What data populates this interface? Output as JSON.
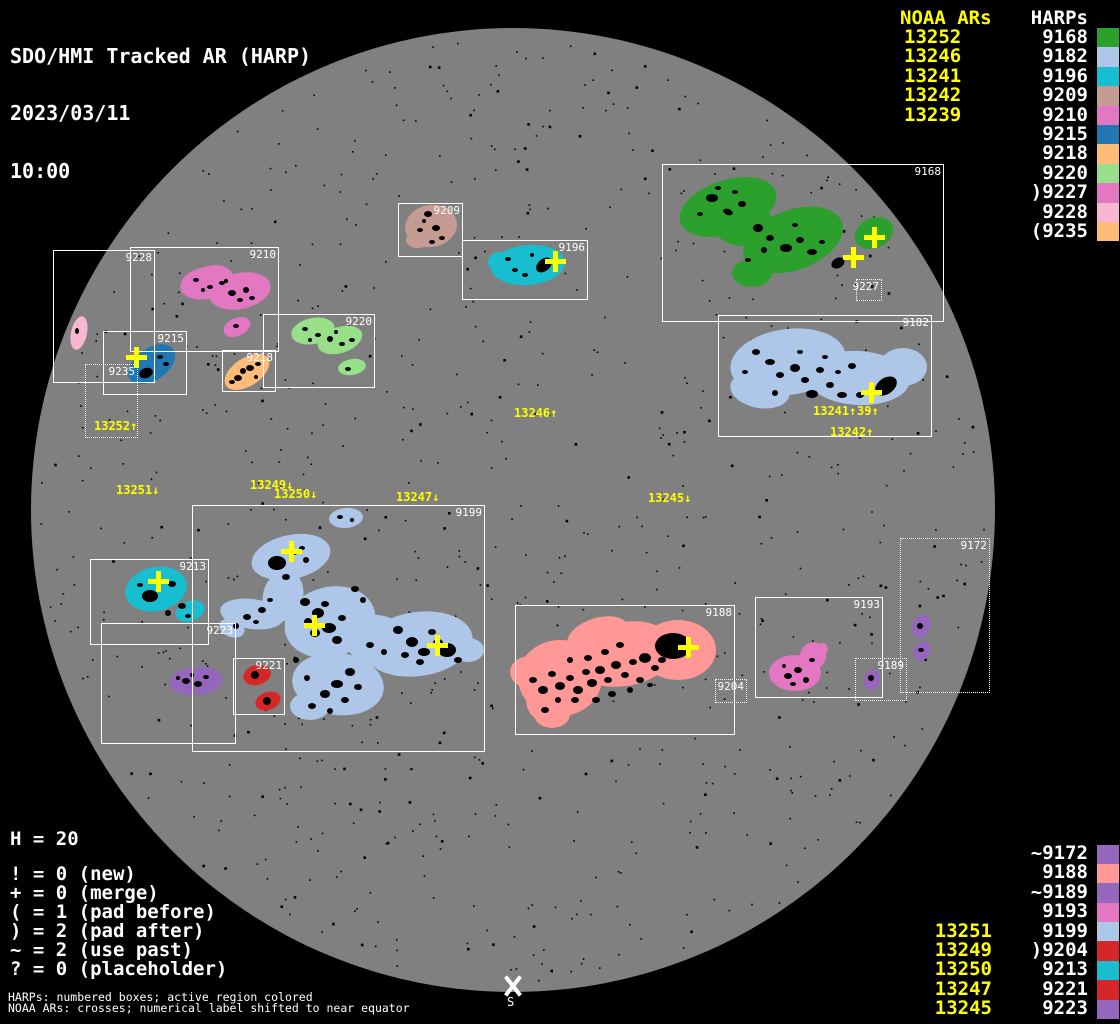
{
  "title": {
    "line1": "SDO/HMI Tracked AR (HARP)",
    "line2": "2023/03/11",
    "line3": "10:00"
  },
  "top_right": {
    "noaa_header": "NOAA ARs",
    "harps_header": "HARPs",
    "noaa": [
      "13252",
      "13246",
      "13241",
      "13242",
      "13239"
    ],
    "harps": [
      {
        "label": "9168",
        "harp": "9168"
      },
      {
        "label": "9182",
        "harp": "9182"
      },
      {
        "label": "9196",
        "harp": "9196"
      },
      {
        "label": "9209",
        "harp": "9209"
      },
      {
        "label": "9210",
        "harp": "9210"
      },
      {
        "label": "9215",
        "harp": "9215"
      },
      {
        "label": "9218",
        "harp": "9218"
      },
      {
        "label": "9220",
        "harp": "9220"
      },
      {
        "label": ")9227",
        "harp": "9227"
      },
      {
        "label": "9228",
        "harp": "9228"
      },
      {
        "label": "(9235",
        "harp": "9235"
      }
    ]
  },
  "bottom_right": {
    "noaa": [
      "13251",
      "13249",
      "13250",
      "13247",
      "13245"
    ],
    "harps": [
      {
        "label": "~9172",
        "harp": "9172"
      },
      {
        "label": "9188",
        "harp": "9188"
      },
      {
        "label": "~9189",
        "harp": "9189"
      },
      {
        "label": "9193",
        "harp": "9193"
      },
      {
        "label": "9199",
        "harp": "9199"
      },
      {
        "label": ")9204",
        "harp": "9204"
      },
      {
        "label": "9213",
        "harp": "9213"
      },
      {
        "label": "9221",
        "harp": "9221"
      },
      {
        "label": "9223",
        "harp": "9223"
      }
    ]
  },
  "legend": {
    "count": "H = 20",
    "lines": [
      "! = 0 (new)",
      "+ = 0 (merge)",
      "( = 1 (pad before)",
      ") = 2 (pad after)",
      "~ = 2 (use past)",
      "? = 0 (placeholder)"
    ],
    "note1": "HARPs: numbered boxes; active region colored",
    "note2": "NOAA ARs: crosses; numerical label shifted to near equator"
  },
  "south_marker": {
    "label": "S"
  },
  "colors": {
    "background": "#000000",
    "disk": "#808080",
    "noaa_text": "#ffff00",
    "harp_text": "#ffffff",
    "box_line": "#ffffff",
    "harp_colors": {
      "9168": "#2ca02c",
      "9182": "#aec7e8",
      "9196": "#17becf",
      "9209": "#c49c94",
      "9210": "#e377c2",
      "9215": "#1f77b4",
      "9218": "#ffbb78",
      "9220": "#98df8a",
      "9227": "#e377c2",
      "9228": "#f7b6d2",
      "9235": "#ffbb78",
      "9172": "#9467bd",
      "9188": "#ff9896",
      "9189": "#9467bd",
      "9193": "#e377c2",
      "9199": "#aec7e8",
      "9204": "#d62728",
      "9213": "#17becf",
      "9221": "#d62728",
      "9223": "#9467bd"
    }
  },
  "chart_data": {
    "type": "scatter",
    "title": "SDO/HMI Tracked AR (HARP)",
    "datetime": "2023/03/11 10:00",
    "harp_total": 20,
    "disk": {
      "cx": 513,
      "cy": 510,
      "r": 482
    },
    "harp_boxes": [
      {
        "harp": "9168",
        "x": 662,
        "y": 164,
        "w": 282,
        "h": 158,
        "dotted": false
      },
      {
        "harp": "9182",
        "x": 718,
        "y": 315,
        "w": 214,
        "h": 122,
        "dotted": false
      },
      {
        "harp": "9209",
        "x": 398,
        "y": 203,
        "w": 65,
        "h": 54,
        "dotted": false
      },
      {
        "harp": "9196",
        "x": 462,
        "y": 240,
        "w": 126,
        "h": 60,
        "dotted": false
      },
      {
        "harp": "9228",
        "x": 53,
        "y": 250,
        "w": 102,
        "h": 133,
        "dotted": false
      },
      {
        "harp": "9210",
        "x": 130,
        "y": 247,
        "w": 149,
        "h": 105,
        "dotted": false
      },
      {
        "harp": "9220",
        "x": 263,
        "y": 314,
        "w": 112,
        "h": 74,
        "dotted": false
      },
      {
        "harp": "9215",
        "x": 103,
        "y": 331,
        "w": 84,
        "h": 64,
        "dotted": false
      },
      {
        "harp": "9218",
        "x": 222,
        "y": 350,
        "w": 54,
        "h": 42,
        "dotted": false
      },
      {
        "harp": "9199",
        "x": 192,
        "y": 505,
        "w": 293,
        "h": 247,
        "dotted": false
      },
      {
        "harp": "9213",
        "x": 90,
        "y": 559,
        "w": 119,
        "h": 86,
        "dotted": false
      },
      {
        "harp": "9223",
        "x": 101,
        "y": 623,
        "w": 135,
        "h": 121,
        "dotted": false
      },
      {
        "harp": "9221",
        "x": 233,
        "y": 658,
        "w": 52,
        "h": 57,
        "dotted": false
      },
      {
        "harp": "9188",
        "x": 515,
        "y": 605,
        "w": 220,
        "h": 130,
        "dotted": false
      },
      {
        "harp": "9193",
        "x": 755,
        "y": 597,
        "w": 128,
        "h": 101,
        "dotted": false
      },
      {
        "harp": "9227",
        "x": 856,
        "y": 279,
        "w": 26,
        "h": 22,
        "dotted": true
      },
      {
        "harp": "9235",
        "x": 85,
        "y": 364,
        "w": 53,
        "h": 74,
        "dotted": true
      },
      {
        "harp": "9204",
        "x": 715,
        "y": 679,
        "w": 32,
        "h": 24,
        "dotted": true
      },
      {
        "harp": "9189",
        "x": 855,
        "y": 658,
        "w": 52,
        "h": 43,
        "dotted": true
      },
      {
        "harp": "9172",
        "x": 900,
        "y": 538,
        "w": 90,
        "h": 155,
        "dotted": true
      }
    ],
    "noaa_crosses": [
      [
        136,
        357
      ],
      [
        555,
        261
      ],
      [
        853,
        257
      ],
      [
        874,
        237
      ],
      [
        871,
        392
      ],
      [
        158,
        581
      ],
      [
        291,
        551
      ],
      [
        314,
        625
      ],
      [
        437,
        645
      ],
      [
        688,
        647
      ]
    ],
    "noaa_labels": [
      {
        "text": "13252↑",
        "x": 94,
        "y": 421
      },
      {
        "text": "13251↓",
        "x": 116,
        "y": 485
      },
      {
        "text": "13249↓",
        "x": 250,
        "y": 480
      },
      {
        "text": "13250↓",
        "x": 274,
        "y": 489
      },
      {
        "text": "13247↓",
        "x": 396,
        "y": 492
      },
      {
        "text": "13246↑",
        "x": 514,
        "y": 408
      },
      {
        "text": "13245↓",
        "x": 648,
        "y": 493
      },
      {
        "text": "13241↑",
        "x": 813,
        "y": 406
      },
      {
        "text": "39↑",
        "x": 857,
        "y": 406
      },
      {
        "text": "13242↑",
        "x": 830,
        "y": 427
      }
    ]
  }
}
